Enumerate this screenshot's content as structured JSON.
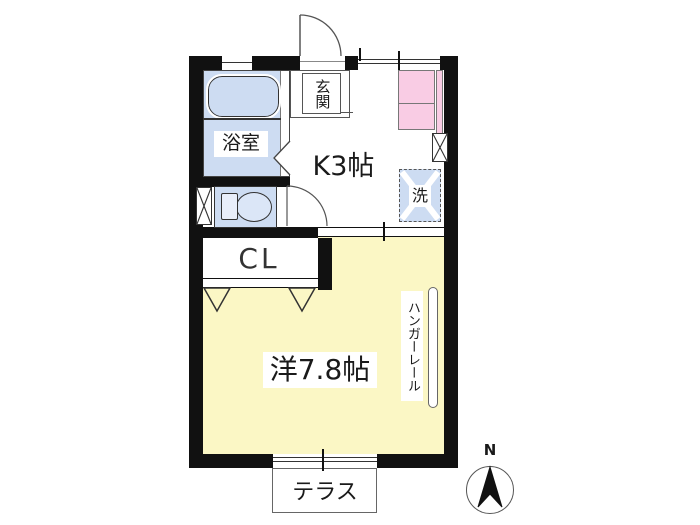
{
  "plan_type": "japanese-apartment-floor-plan",
  "colors": {
    "wall": "#111111",
    "room_yellow": "#fbf7c5",
    "water_blue": "#cddcf2",
    "counter_pink": "#f9cce4"
  },
  "labels": {
    "entrance": "玄関",
    "kitchen": "K3帖",
    "bath": "浴室",
    "laundry": "洗",
    "closet": "CL",
    "living": "洋7.8帖",
    "hanger_rail": "ハンガーレール",
    "terrace": "テラス",
    "compass_north": "N"
  }
}
